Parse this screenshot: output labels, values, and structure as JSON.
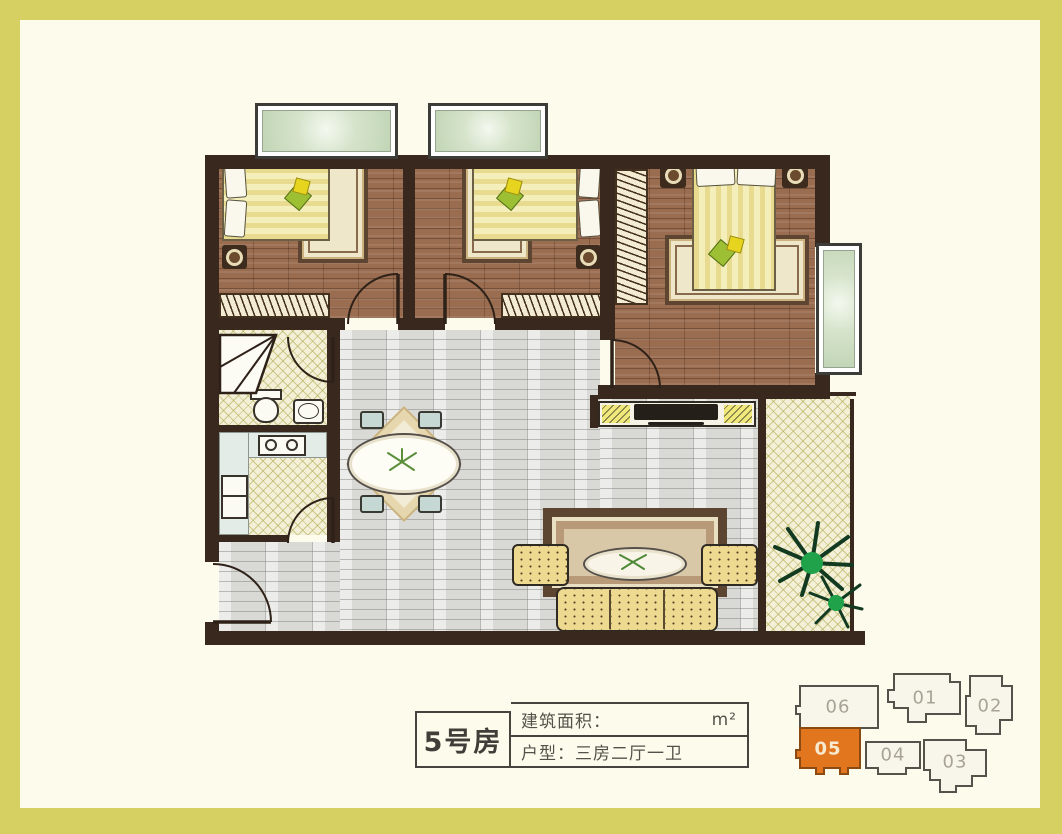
{
  "colors": {
    "frame_border": "#d6d063",
    "background": "#fdfcec",
    "wall": "#38281e",
    "wood_floor": "#9a6d50",
    "hall_floor": "#d9d9d6",
    "tile_floor": "#f4f0d8",
    "window_glass": "#d5e3ca",
    "bed": "#f4eebb",
    "sofa": "#eed990",
    "highlight_unit": "#e2761f"
  },
  "info_table": {
    "room_no": "5号房",
    "area_label": "建筑面积：",
    "area_value": "",
    "area_unit": "m²",
    "layout_label": "户型：三房二厅一卫"
  },
  "key_plan": {
    "highlighted": "05",
    "units": [
      {
        "id": "06"
      },
      {
        "id": "01"
      },
      {
        "id": "02"
      },
      {
        "id": "05"
      },
      {
        "id": "04"
      },
      {
        "id": "03"
      }
    ]
  }
}
